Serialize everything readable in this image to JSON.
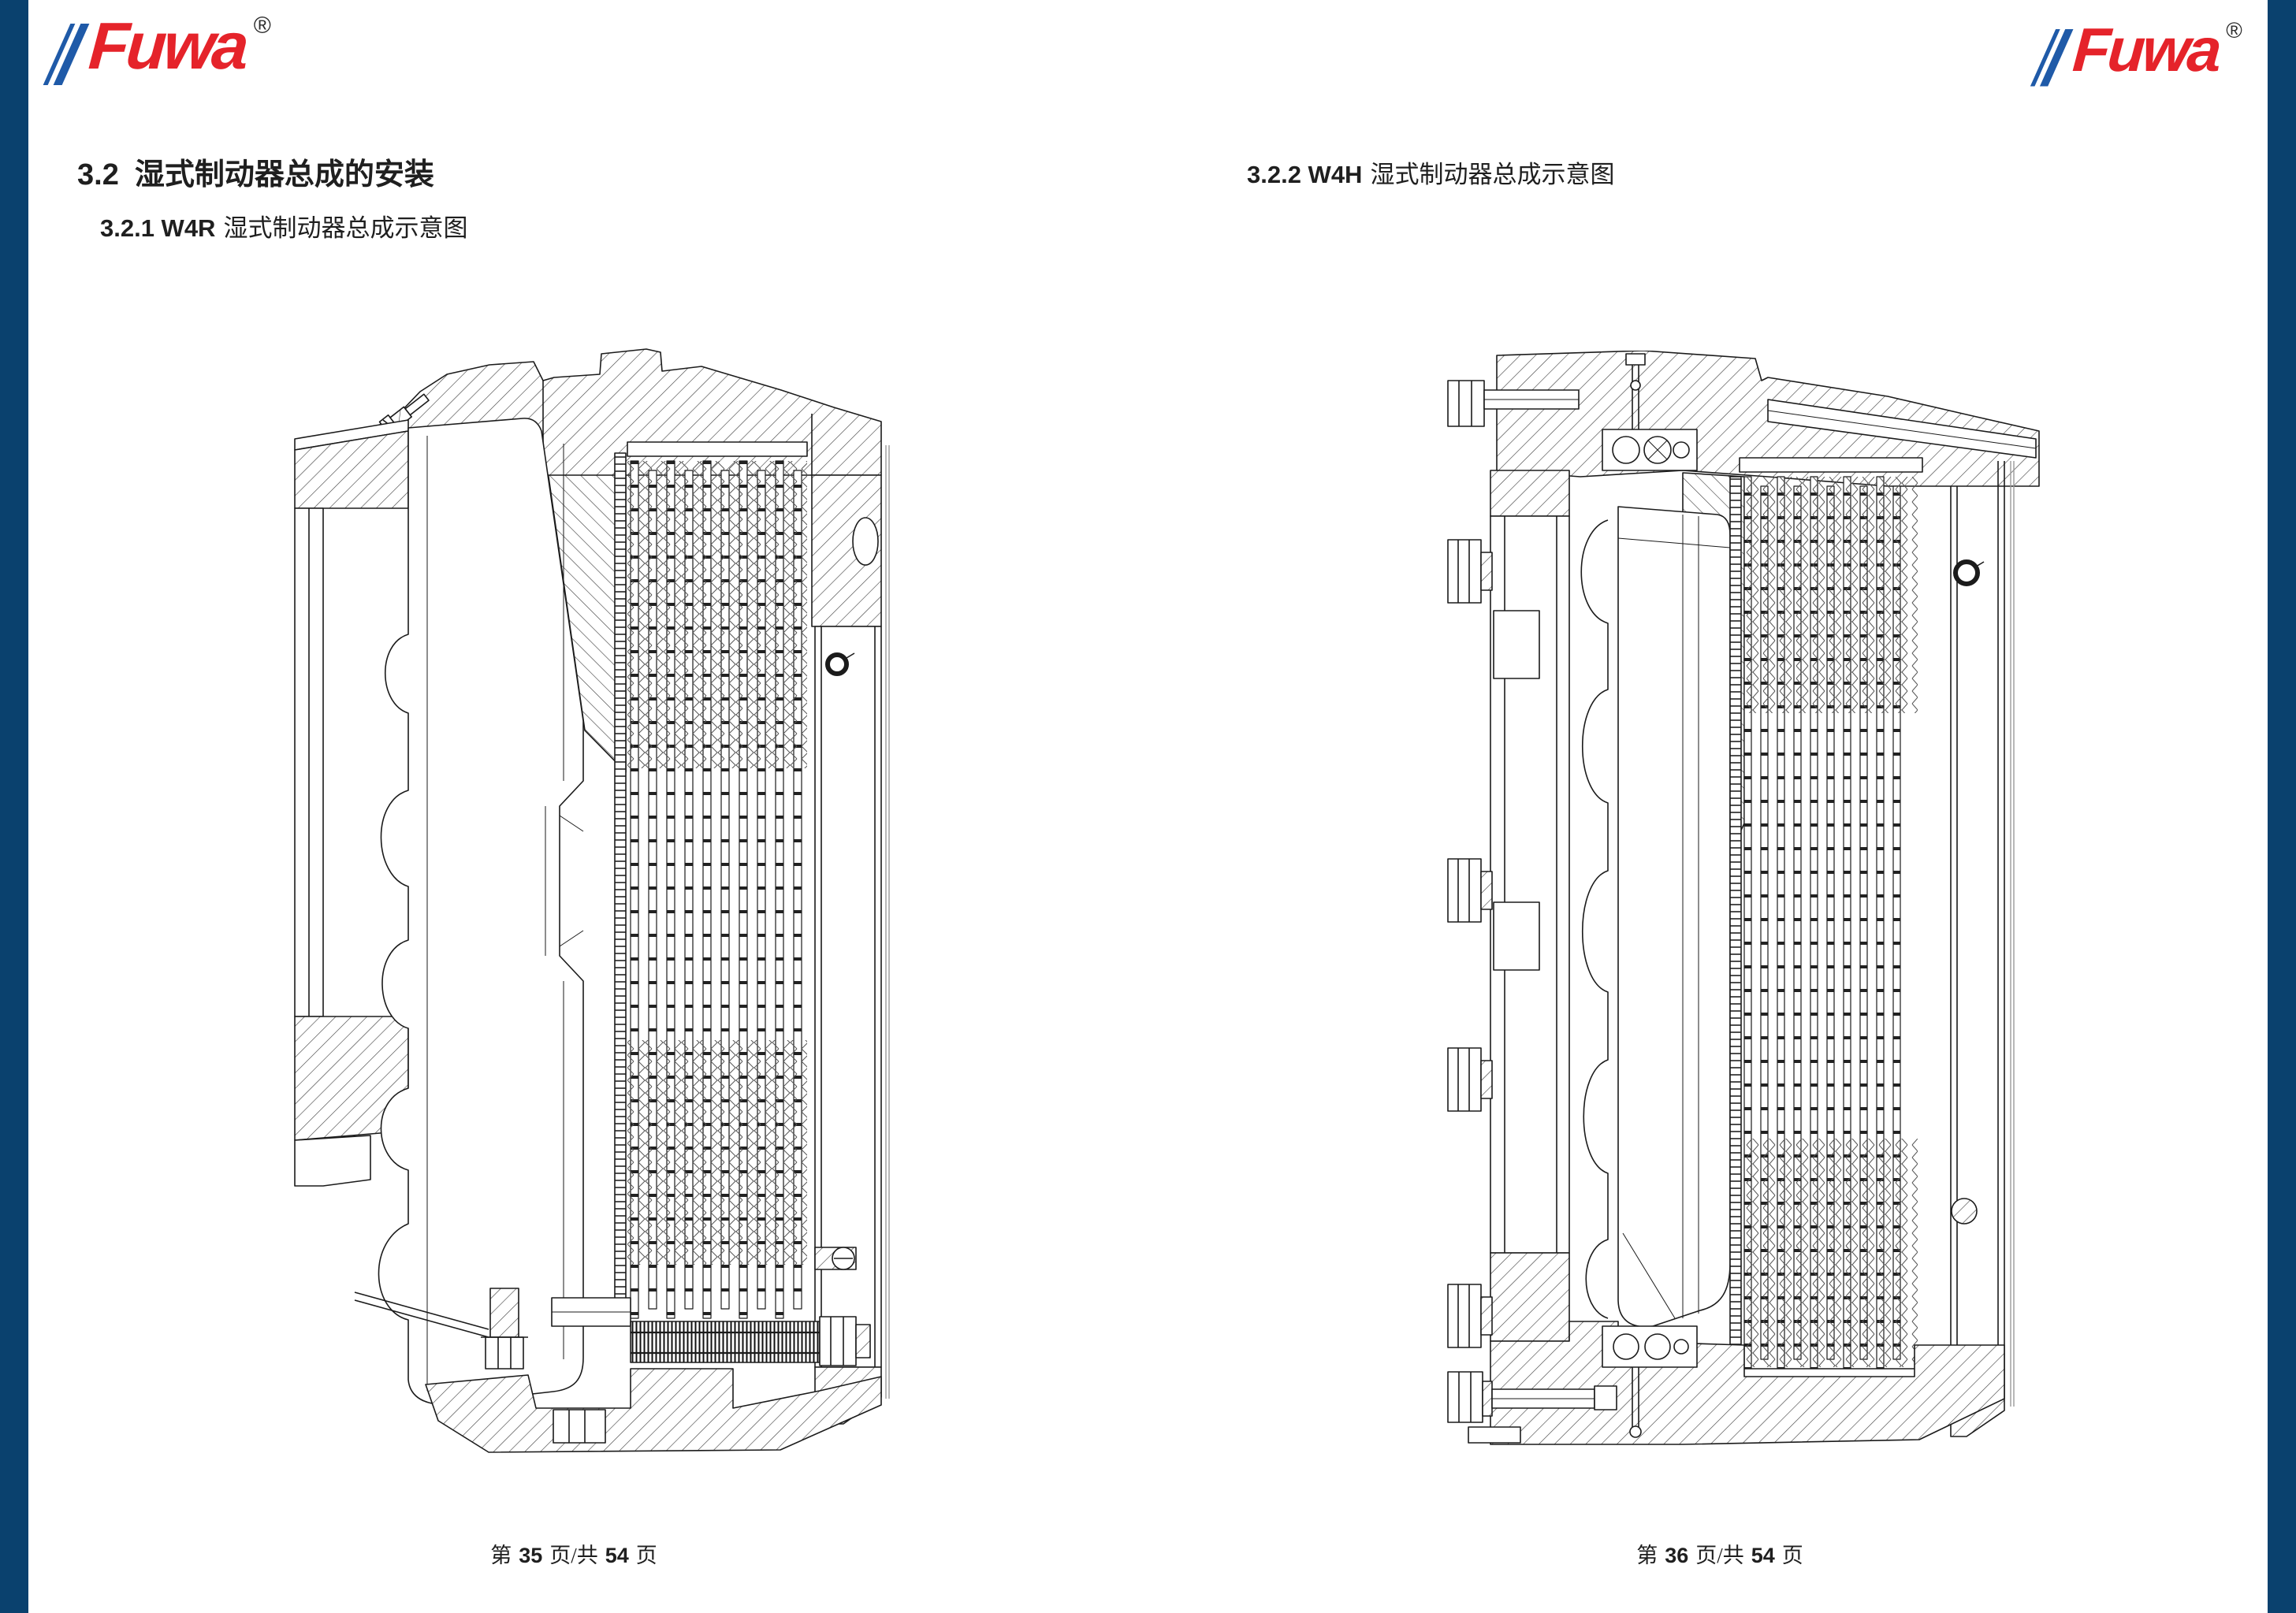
{
  "page": {
    "background": "#ffffff",
    "edge_bar_color": "#0a416e"
  },
  "brand": {
    "logo_text": "Fuwa",
    "registered_mark": "®",
    "logo_red": "#e5232a",
    "stripe_blue": "#1f5aa8"
  },
  "left_page": {
    "section_heading": {
      "num": "3.2",
      "text": "湿式制动器总成的安装"
    },
    "sub_heading": {
      "num": "3.2.1 W4R",
      "text": "湿式制动器总成示意图"
    },
    "footer": {
      "prefix": "第",
      "page_number": "35",
      "infix": "页/共",
      "total_pages": "54",
      "suffix": "页"
    }
  },
  "right_page": {
    "section_heading": {
      "num": "3.2.2 W4H",
      "text": "湿式制动器总成示意图"
    },
    "footer": {
      "prefix": "第",
      "page_number": "36",
      "infix": "页/共",
      "total_pages": "54",
      "suffix": "页"
    }
  }
}
